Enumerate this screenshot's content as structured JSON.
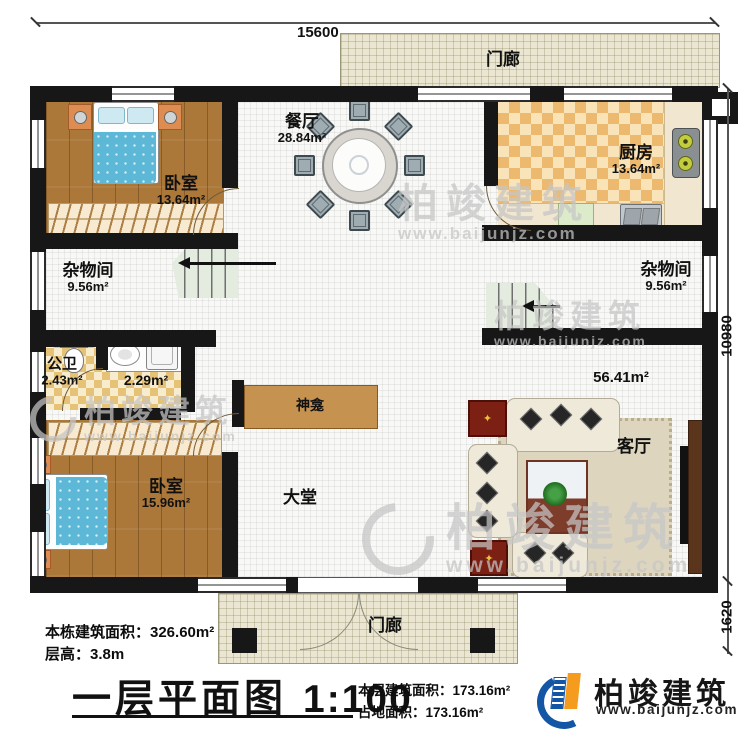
{
  "dimensions": {
    "top": "15600",
    "right": "10980",
    "right_lower": "1620"
  },
  "rooms": {
    "porch_top": {
      "name": "门廊"
    },
    "porch_bottom": {
      "name": "门廊"
    },
    "dining": {
      "name": "餐厅",
      "area": "28.84m²"
    },
    "kitchen": {
      "name": "厨房",
      "area": "13.64m²"
    },
    "bedroom_top": {
      "name": "卧室",
      "area": "13.64m²"
    },
    "storage_left": {
      "name": "杂物间",
      "area": "9.56m²"
    },
    "storage_right": {
      "name": "杂物间",
      "area": "9.56m²"
    },
    "bath": {
      "name": "公卫",
      "area": "2.43m²"
    },
    "laundry": {
      "area": "2.29m²"
    },
    "shrine": {
      "name": "神龛"
    },
    "hall": {
      "name": "大堂"
    },
    "living": {
      "name": "客厅",
      "area": "56.41m²"
    },
    "bedroom_bottom": {
      "name": "卧室",
      "area": "15.96m²"
    }
  },
  "footer": {
    "total_area": "本栋建筑面积：326.60m²",
    "floor_height": "层高：3.8m",
    "title": "一层平面图",
    "scale": "1:100",
    "floor_area": "本层建筑面积：173.16m²",
    "land_area": "占地面积：173.16m²"
  },
  "brand": {
    "name": "柏竣建筑",
    "url": "www.baijunjz.com"
  },
  "colors": {
    "wall": "#171717",
    "wood": "#ac783a",
    "logo_blue": "#1356a5",
    "logo_orange": "#f59b1e"
  }
}
